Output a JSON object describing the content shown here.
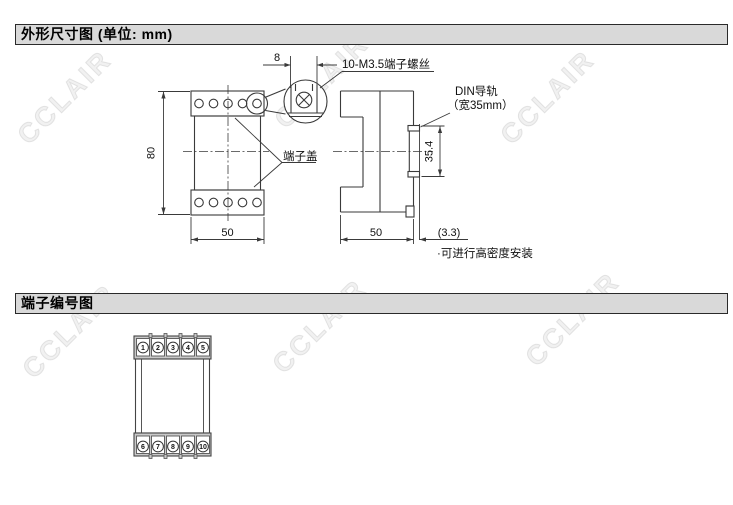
{
  "watermark": {
    "text": "CCLAIR"
  },
  "section1": {
    "header": "外形尺寸图 (单位: mm)",
    "labels": {
      "screw_callout": "10-M3.5端子螺丝",
      "terminal_cover": "端子盖",
      "din_rail_line1": "DIN导轨",
      "din_rail_line2": "（宽35mm）",
      "note": "·可进行高密度安装"
    },
    "dimensions": {
      "front_height": "80",
      "front_width": "50",
      "screw_pitch": "8",
      "side_depth": "50",
      "rail_offset": "(3.3)",
      "rail_span": "35.4"
    }
  },
  "section2": {
    "header": "端子编号图",
    "terminals": {
      "top": [
        "1",
        "2",
        "3",
        "4",
        "5"
      ],
      "bottom": [
        "6",
        "7",
        "8",
        "9",
        "10"
      ]
    }
  },
  "colors": {
    "header_bg": "#d9d9d9",
    "line": "#3a3a3a",
    "strip_fill": "#c9c9c9"
  }
}
